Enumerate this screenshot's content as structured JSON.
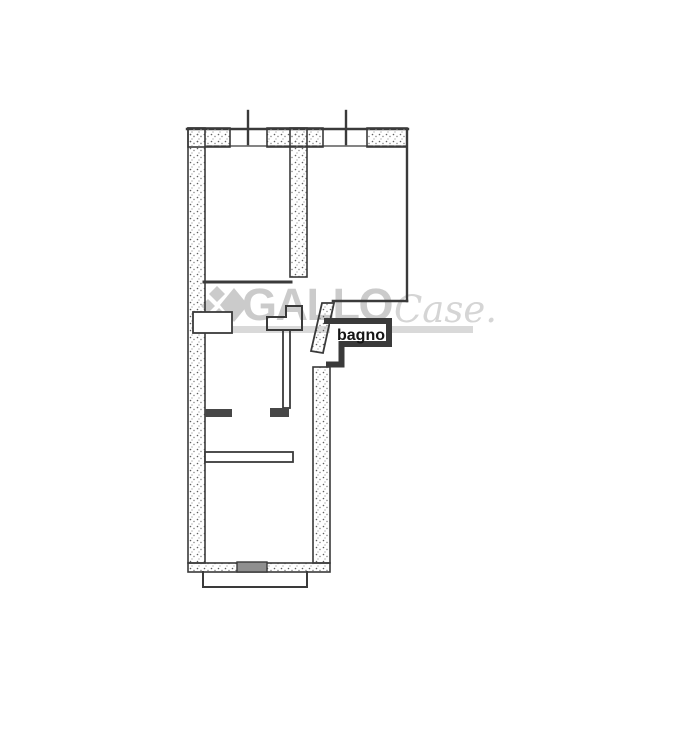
{
  "watermark": {
    "brand_primary": "GALLO",
    "brand_secondary": "Case.",
    "logo_icon": "gallo-diamonds-icon",
    "primary_color": "#cbcbcb",
    "secondary_color": "#d5d5d5",
    "underline_color": "#d9d9d9"
  },
  "floor_plan": {
    "ink_color": "#3a3a3a",
    "threshold_color": "#8f8f8f",
    "label_color": "#151515",
    "room_labels": [
      {
        "text": "bagno"
      }
    ]
  }
}
